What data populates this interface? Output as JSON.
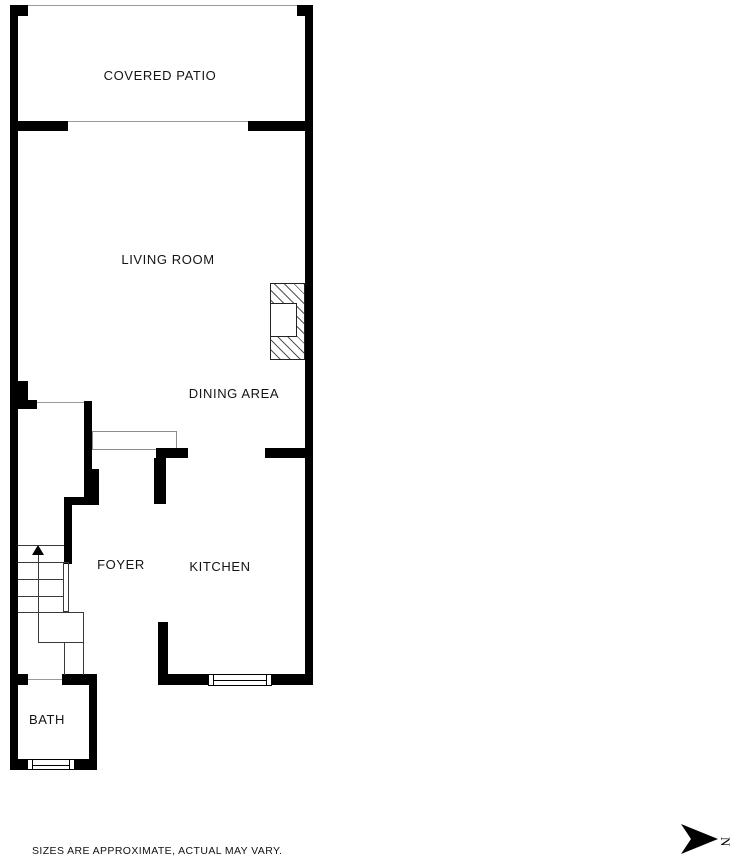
{
  "plan": {
    "rooms": [
      {
        "id": "covered-patio",
        "label": "COVERED PATIO"
      },
      {
        "id": "living-room",
        "label": "LIVING ROOM"
      },
      {
        "id": "dining-area",
        "label": "DINING AREA"
      },
      {
        "id": "foyer",
        "label": "FOYER"
      },
      {
        "id": "kitchen",
        "label": "KITCHEN"
      },
      {
        "id": "bath",
        "label": "BATH"
      }
    ],
    "disclaimer": "SIZES ARE APPROXIMATE, ACTUAL MAY VARY.",
    "north_label": "N",
    "colors": {
      "wall": "#000000",
      "background": "#ffffff",
      "thin_line": "#8c8c8c",
      "text": "#141414"
    }
  }
}
